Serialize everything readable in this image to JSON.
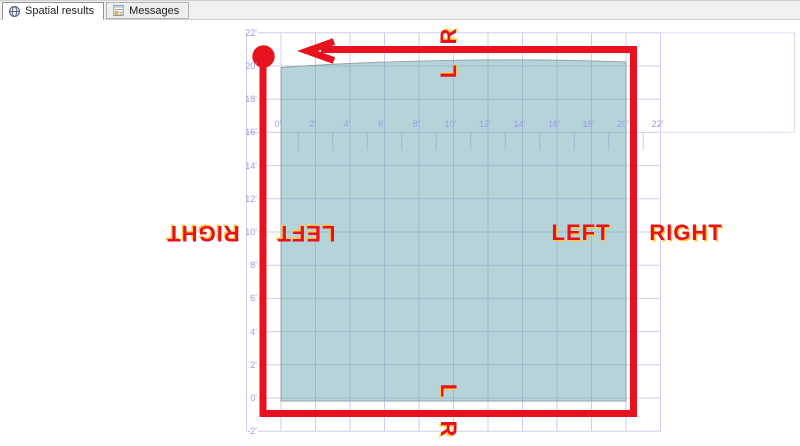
{
  "window": {
    "width": 800,
    "height": 446
  },
  "tabs": [
    {
      "label": "Spatial results",
      "icon": "globe-icon",
      "active": true
    },
    {
      "label": "Messages",
      "icon": "messages-icon",
      "active": false
    }
  ],
  "axes": {
    "x": [
      "0'",
      "2'",
      "4'",
      "6'",
      "8'",
      "10'",
      "12'",
      "14'",
      "16'",
      "18'",
      "20'",
      "22'"
    ],
    "y": [
      "22'",
      "20'",
      "18'",
      "16'",
      "14'",
      "12'",
      "10'",
      "8'",
      "6'",
      "4'",
      "2'",
      "0'",
      "-2'"
    ]
  },
  "annotations": {
    "top_outer": "R",
    "top_inner": "L",
    "bottom_inner": "L",
    "bottom_outer": "R",
    "right_inner": "LEFT",
    "right_outer": "RIGHT",
    "left_outer": "RIGHT",
    "left_inner": "LEFT"
  },
  "colors": {
    "annotation_red": "#e8121f",
    "label_highlight": "#ffc942",
    "polygon_fill": "#b5d3d8",
    "grid_line": "#cdcdf0",
    "axis_label_text": "#9b9ce6"
  },
  "chart_data": {
    "type": "spatial-plot",
    "unit": "feet",
    "x_ticks": [
      "0'",
      "2'",
      "4'",
      "6'",
      "8'",
      "10'",
      "12'",
      "14'",
      "16'",
      "18'",
      "20'",
      "22'"
    ],
    "y_ticks": [
      "22'",
      "20'",
      "18'",
      "16'",
      "14'",
      "12'",
      "10'",
      "8'",
      "6'",
      "4'",
      "2'",
      "0'",
      "-2'"
    ],
    "x_range_ft": [
      -2,
      24
    ],
    "y_range_ft": [
      -2,
      22
    ],
    "grid": "on, lavender lines every 2 ft",
    "shapes": [
      {
        "name": "filled-region",
        "type": "polygon",
        "fill": "#b5d3d8",
        "x_min_ft": 0,
        "x_max_ft": 20,
        "y_min_ft": 0,
        "y_max_ft": 20.3,
        "note": "square region 0-20 ft with slightly arched top edge"
      },
      {
        "name": "route-outline",
        "type": "path",
        "color": "#e8121f",
        "stroke_px": 7,
        "points_ft": [
          [
            -1,
            20.6
          ],
          [
            -1,
            -0.9
          ],
          [
            20.4,
            -0.9
          ],
          [
            20.4,
            21.0
          ],
          [
            1.5,
            21.0
          ]
        ],
        "start_dot_ft": [
          -1,
          20.6
        ],
        "arrow": "arrowhead pointing left on top edge"
      }
    ],
    "labels": [
      {
        "text": "R",
        "position": "top edge, outside",
        "rotation_deg": -90
      },
      {
        "text": "L",
        "position": "top edge, inside",
        "rotation_deg": -90
      },
      {
        "text": "LEFT",
        "position": "right edge, inside",
        "rotation_deg": 0
      },
      {
        "text": "RIGHT",
        "position": "right edge, outside",
        "rotation_deg": 0
      },
      {
        "text": "RIGHT",
        "position": "left edge, outside",
        "rotation_deg": 180
      },
      {
        "text": "LEFT",
        "position": "left edge, inside",
        "rotation_deg": 180
      },
      {
        "text": "L",
        "position": "bottom edge, inside",
        "rotation_deg": 90
      },
      {
        "text": "R",
        "position": "bottom edge, outside",
        "rotation_deg": 90
      }
    ]
  }
}
